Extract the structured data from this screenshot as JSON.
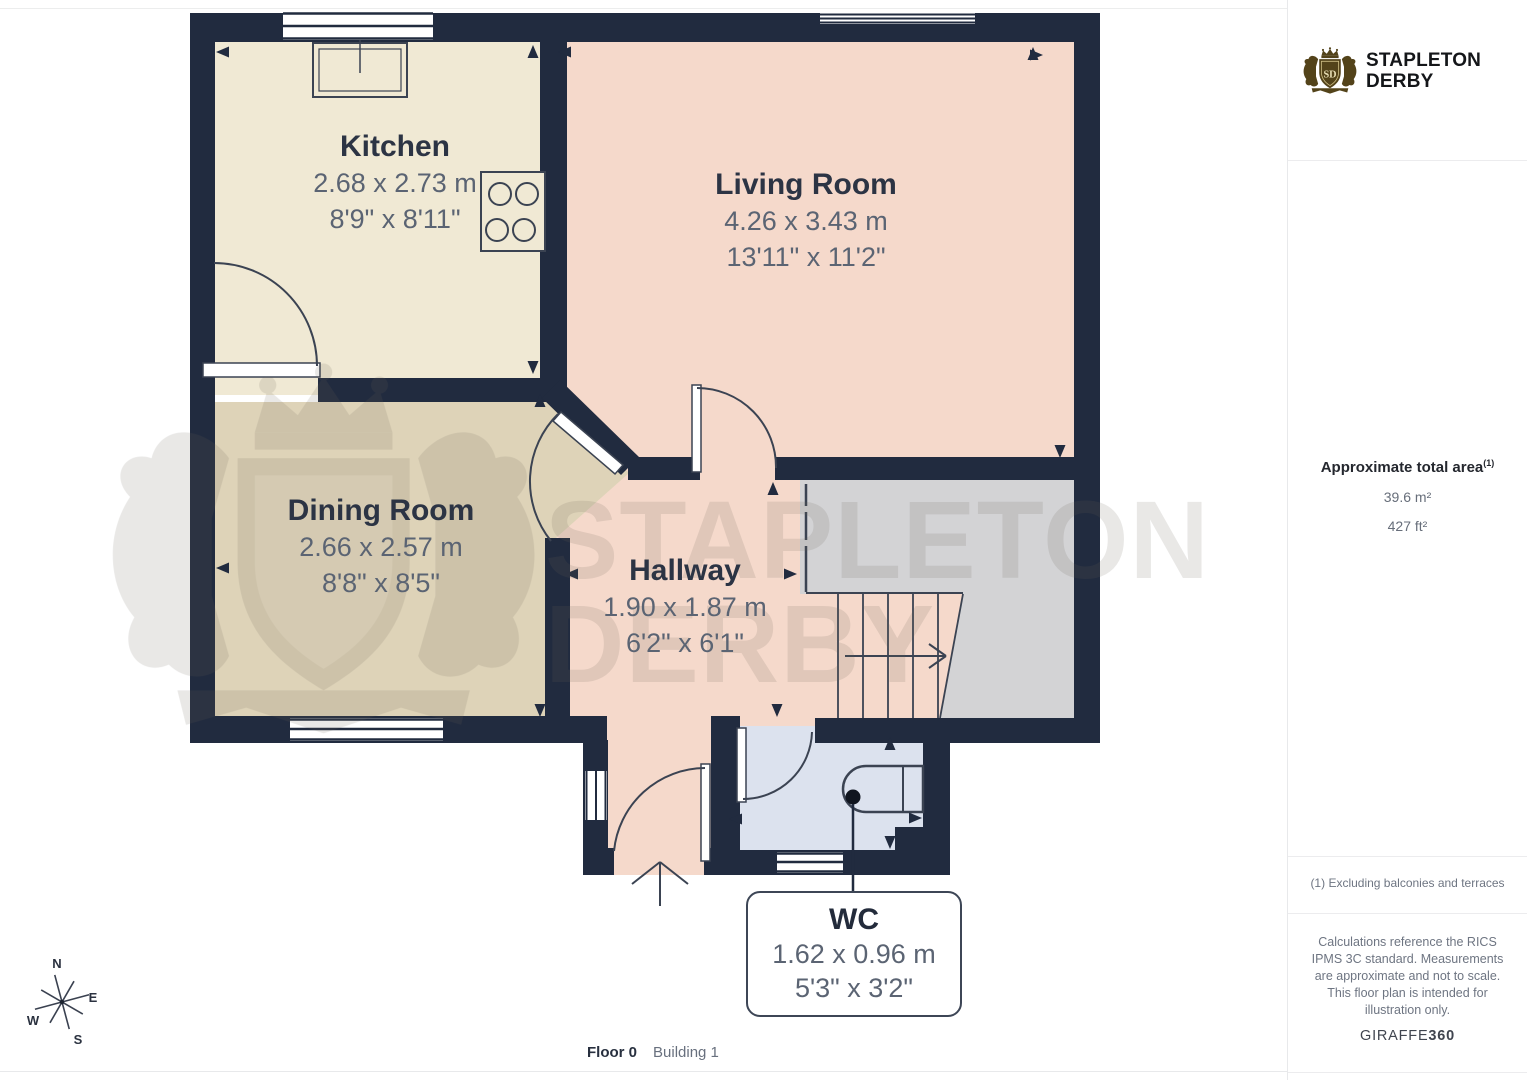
{
  "branding": {
    "monogram": "SD",
    "name_line1": "STAPLETON",
    "name_line2": "DERBY",
    "logo_color": "#53431a"
  },
  "plan": {
    "rooms": [
      {
        "name": "Kitchen",
        "metric": "2.68 x 2.73 m",
        "imperial": "8'9\" x 8'11\""
      },
      {
        "name": "Living Room",
        "metric": "4.26 x 3.43 m",
        "imperial": "13'11\" x 11'2\""
      },
      {
        "name": "Dining Room",
        "metric": "2.66 x 2.57 m",
        "imperial": "8'8\" x 8'5\""
      },
      {
        "name": "Hallway",
        "metric": "1.90 x 1.87 m",
        "imperial": "6'2\" x 6'1\""
      },
      {
        "name": "WC",
        "metric": "1.62 x 0.96 m",
        "imperial": "5'3\" x 3'2\""
      }
    ],
    "compass": {
      "n": "N",
      "e": "E",
      "s": "S",
      "w": "W"
    }
  },
  "sidebar": {
    "area_title": "Approximate total area",
    "area_marker": "(1)",
    "area_m2": "39.6 m²",
    "area_ft2": "427 ft²",
    "footnote": "(1) Excluding balconies and terraces",
    "disclaimer": "Calculations reference the RICS IPMS 3C standard. Measurements are approximate and not to scale. This floor plan is intended for illustration only.",
    "provider_name": "GIRAFFE",
    "provider_suffix": "360"
  },
  "footer": {
    "floor": "Floor 0",
    "building": "Building 1"
  },
  "colors": {
    "wall": "#212b3f",
    "kitchen_floor": "#f0e9d4",
    "living_floor": "#f5d9cb",
    "dining_floor": "#ded3b8",
    "stairs_area": "#d3d3d5",
    "wc_floor": "#dce2ee",
    "watermark": "#6b655b"
  }
}
